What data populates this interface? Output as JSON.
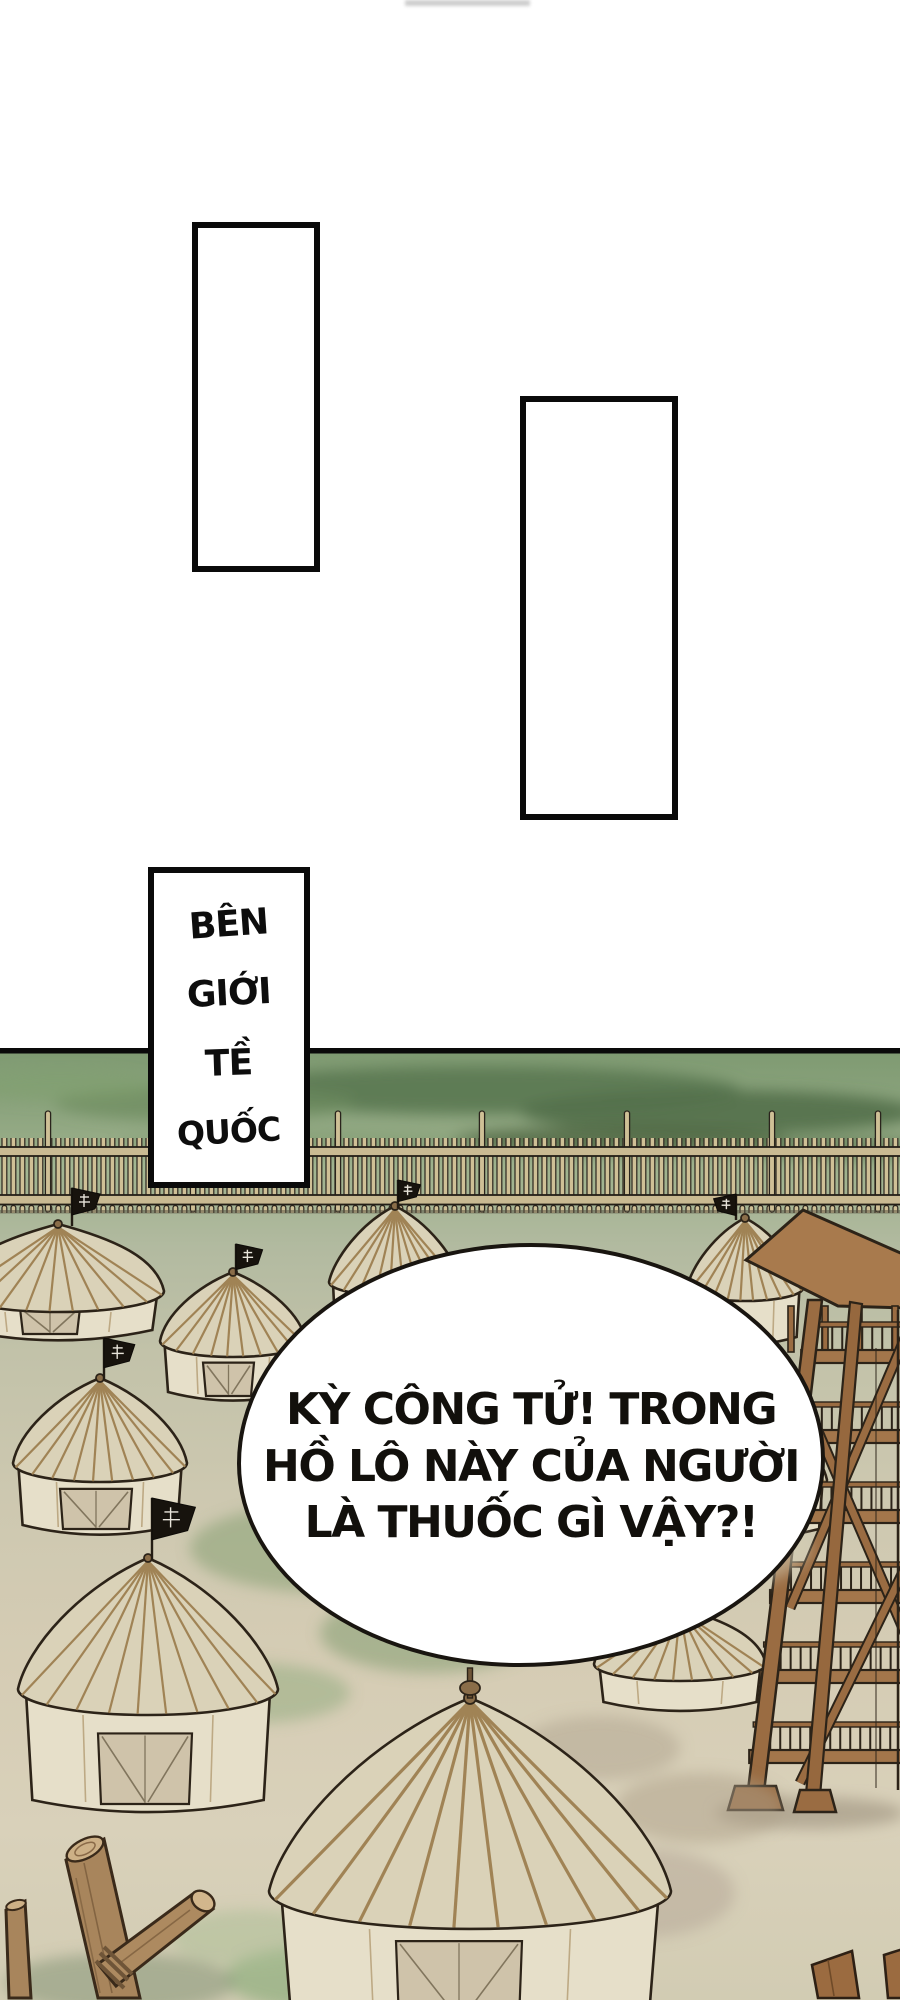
{
  "page": {
    "background": "#ffffff"
  },
  "caption_box": {
    "words": [
      "BÊN",
      "GIỚI",
      "TỀ",
      "QUỐC"
    ]
  },
  "speech_bubble": {
    "lines": [
      "KỲ CÔNG TỬ! TRONG",
      "HỒ LÔ NÀY CỦA NGƯỜI",
      "LÀ THUỐC GÌ VẬY?!"
    ]
  },
  "scene": {
    "flag_emblem_character": "齊",
    "colors": {
      "panel_border": "#0a0a0a",
      "grass": "#8ba37d",
      "hill_shadow": "#52704b",
      "fence_wood": "#cfc096",
      "fence_rail": "#c9ba92",
      "tent_canvas": "#e6dfc9",
      "tent_roof": "#dad2b8",
      "tent_rib": "#a08355",
      "tent_door": "#cfc3aa",
      "flag_black": "#17130d",
      "tower_wood": "#a3764b",
      "tower_wood_dark": "#9a6c42",
      "log_wood": "#a8855c",
      "ground": "#d7cdb6",
      "outline": "#2c2318",
      "bubble_fill": "#ffffff"
    }
  }
}
